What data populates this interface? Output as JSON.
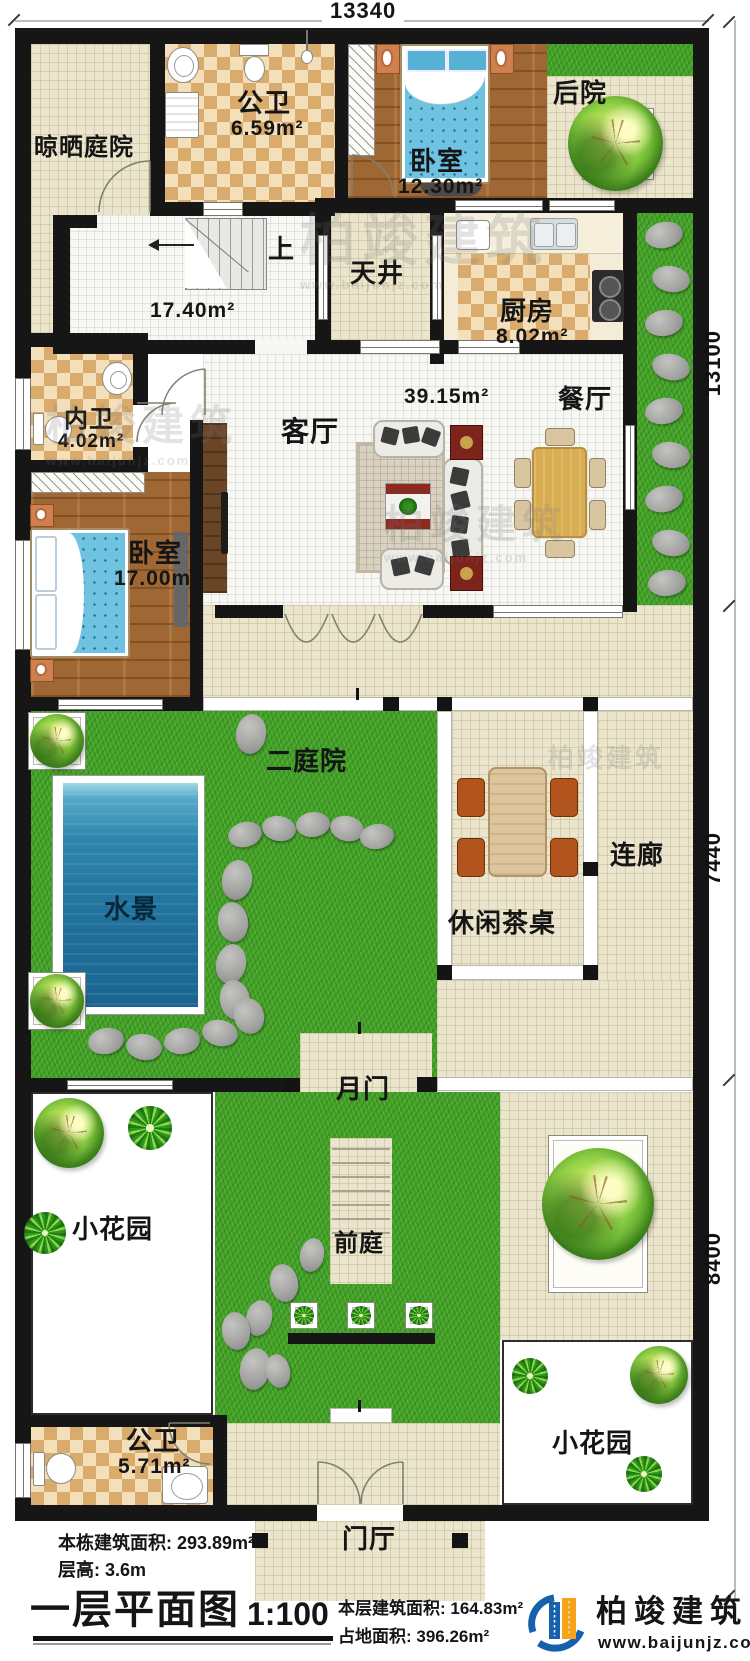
{
  "dimensions": {
    "top": "13340",
    "right_top": "13100",
    "right_middle": "7440",
    "right_bottom": "8400"
  },
  "rooms": {
    "drying_yard": {
      "name": "晾晒庭院"
    },
    "bath_top": {
      "name": "公卫",
      "area": "6.59m²"
    },
    "bedroom_top": {
      "name": "卧室",
      "area": "12.30m²"
    },
    "backyard": {
      "name": "后院"
    },
    "stairs": {
      "up": "上",
      "area": "17.40m²"
    },
    "atrium": {
      "name": "天井"
    },
    "kitchen": {
      "name": "厨房",
      "area": "8.02m²"
    },
    "bath_inner": {
      "name": "内卫",
      "area": "4.02m²"
    },
    "living": {
      "name": "客厅",
      "area": "39.15m²"
    },
    "dining": {
      "name": "餐厅"
    },
    "bedroom_main": {
      "name": "卧室",
      "area": "17.00m²"
    },
    "courtyard2": {
      "name": "二庭院"
    },
    "water_feature": {
      "name": "水景"
    },
    "corridor": {
      "name": "连廊"
    },
    "tea_table": {
      "name": "休闲茶桌"
    },
    "moon_gate": {
      "name": "月门"
    },
    "garden_left": {
      "name": "小花园"
    },
    "front_yard": {
      "name": "前庭"
    },
    "bath_bottom": {
      "name": "公卫",
      "area": "5.71m²"
    },
    "garden_right": {
      "name": "小花园"
    },
    "foyer": {
      "name": "门厅"
    }
  },
  "footer": {
    "building_area": "本栋建筑面积: 293.89m²",
    "floor_height": "层高: 3.6m",
    "plan_title": "一层平面图",
    "scale": "1:100",
    "floor_area": "本层建筑面积: 164.83m²",
    "land_area": "占地面积: 396.26m²",
    "brand": "柏竣建筑",
    "website": "www.baijunjz.com"
  },
  "watermark": {
    "brand": "柏竣建筑",
    "site": "www.baijunjz.com"
  }
}
